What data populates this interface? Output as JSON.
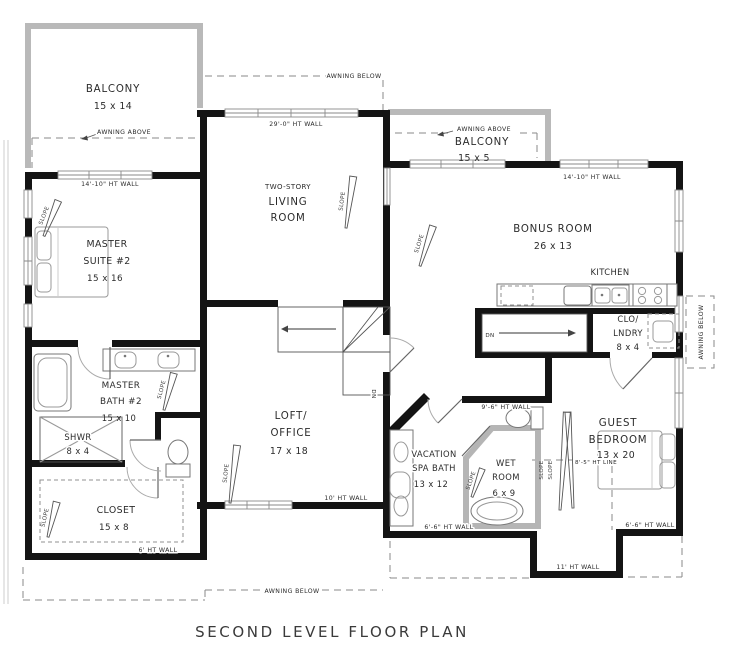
{
  "title": "SECOND LEVEL FLOOR PLAN",
  "rooms": {
    "balcony_tl": {
      "name": "BALCONY",
      "dims": "15 x 14"
    },
    "balcony_tr": {
      "name": "BALCONY",
      "dims": "15 x 5"
    },
    "master_suite": {
      "l1": "MASTER",
      "l2": "SUITE #2",
      "dims": "15 x 16"
    },
    "living_room": {
      "l1": "TWO-STORY",
      "l2": "LIVING",
      "l3": "ROOM"
    },
    "bonus_room": {
      "name": "BONUS ROOM",
      "dims": "26 x 13"
    },
    "kitchen": {
      "name": "KITCHEN"
    },
    "clo_laundry": {
      "l1": "CLO/",
      "l2": "LNDRY",
      "dims": "8 x 4"
    },
    "master_bath": {
      "l1": "MASTER",
      "l2": "BATH #2",
      "dims": "15 x 10"
    },
    "shower": {
      "l1": "SHWR",
      "dims": "8 x 4"
    },
    "closet": {
      "name": "CLOSET",
      "dims": "15 x 8"
    },
    "loft_office": {
      "l1": "LOFT/",
      "l2": "OFFICE",
      "dims": "17 x 18"
    },
    "spa_bath": {
      "l1": "VACATION",
      "l2": "SPA BATH",
      "dims": "13 x 12"
    },
    "wet_room": {
      "l1": "WET",
      "l2": "ROOM",
      "dims": "6 x 9"
    },
    "guest_bedroom": {
      "l1": "GUEST",
      "l2": "BEDROOM",
      "dims": "13 x 20"
    }
  },
  "labels": {
    "wall_14_10": "14'-10\" HT WALL",
    "wall_29_0": "29'-0\" HT WALL",
    "wall_10": "10' HT WALL",
    "wall_9_6": "9'-6\" HT WALL",
    "wall_6_6": "6'-6\" HT WALL",
    "wall_11": "11' HT WALL",
    "wall_6": "6' HT WALL",
    "ht_line_8_5": "8'-5\" HT LINE",
    "awning_above": "AWNING ABOVE",
    "awning_below": "AWNING BELOW",
    "slope": "SLOPE",
    "down": "DN"
  },
  "colors": {
    "wall": "#141414",
    "balcony_gray": "#b9b9b9",
    "dash_gray": "#8a8a8a",
    "text": "#2b2b2b",
    "background": "#ffffff"
  }
}
